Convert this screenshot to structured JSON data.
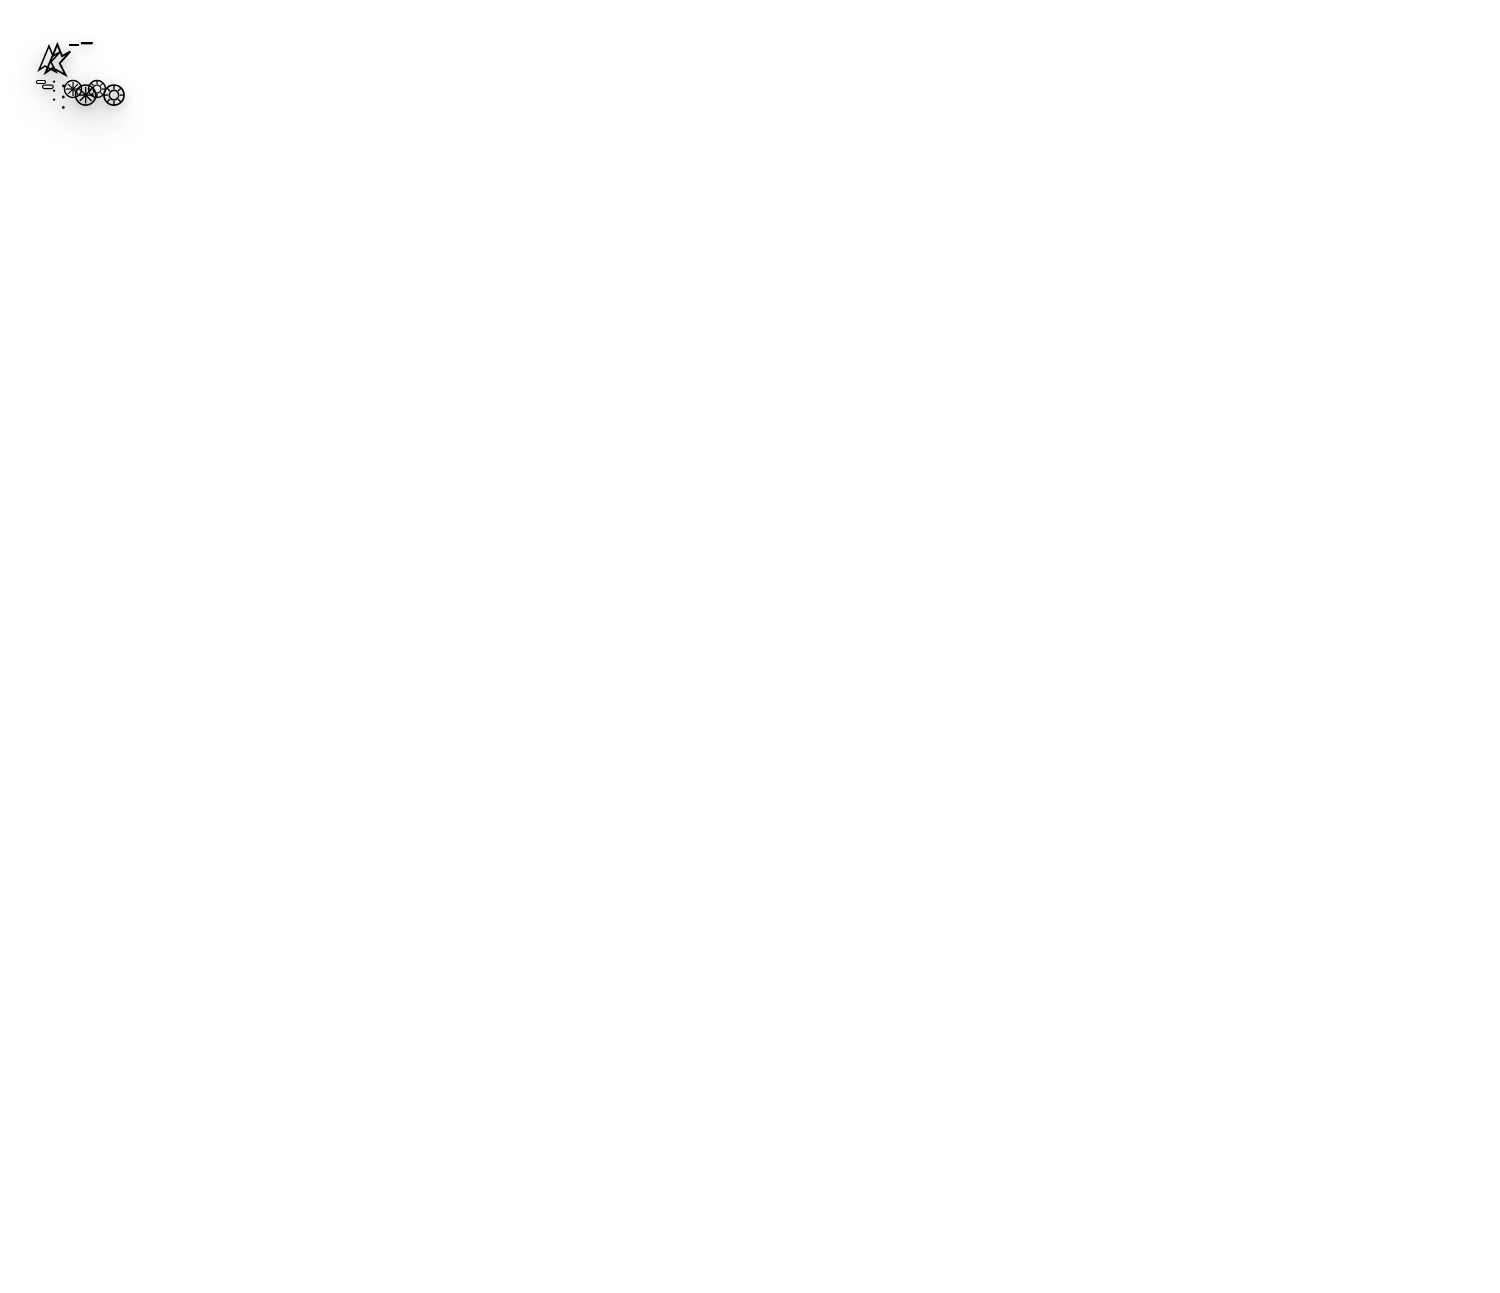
{
  "scene": {
    "width": 1500,
    "height": 1293,
    "background": "#ffffff"
  },
  "back_mat": {
    "imperial_label": "IMPERIAL",
    "branding": {
      "brand": "Elan",
      "brand_sub": "Arts & Crafts",
      "size_title": "A1 Size :",
      "size_value": "23.5 x 35.5 Inch",
      "product": "Self - Healing Cutting Mat",
      "warning": "WARNING",
      "bullets": [
        "Remain flat - Do not roll.",
        "Avoid direct heat and sunlight.",
        "Cut in different positions to extend the life of cutting mat."
      ],
      "origin": "MADE IN TAIWAN"
    },
    "colors": {
      "surface": "#0d7a68",
      "edge": "#094f42",
      "grid": "#cfc75f",
      "bright": "#e8e17a",
      "text": "#ece580"
    },
    "geometry": {
      "left": 2,
      "top": 8,
      "width": 1489,
      "height": 1114,
      "radius": 18,
      "margin": 44,
      "cols": 34.4,
      "rows": 22.4,
      "rotation": 0
    },
    "rulers": {
      "top": {
        "start": 1,
        "end": 34
      },
      "bottom": {
        "start": 1,
        "end": 34
      },
      "left": {
        "start": 1,
        "end": 22
      },
      "right": {
        "start": 1,
        "end": 22
      }
    },
    "solid_lines": [
      [
        0,
        22.4,
        22.4,
        0
      ],
      [
        0,
        22.4,
        6.0,
        0
      ],
      [
        0,
        22.4,
        12.9,
        0
      ],
      [
        24.6,
        12.6,
        34.35,
        22.35
      ]
    ],
    "dashed_lines": [
      [
        0,
        22.4,
        34.4,
        2.6
      ],
      [
        12.8,
        0,
        26.8,
        14.0
      ],
      [
        26.6,
        16.5,
        32.5,
        22.4
      ],
      [
        0,
        13.9,
        8.5,
        22.4
      ]
    ],
    "corner_arcs": [
      {
        "cx": 34.4,
        "cy": 22.4,
        "r": 2.3
      }
    ],
    "angle_arcs": [
      {
        "cx": 17.6,
        "cy": 4.8,
        "r": 1.4,
        "a0": 200,
        "a1": 340
      }
    ],
    "protractor": {
      "q": [
        [
          0,
          16.2
        ],
        [
          7.6,
          17.9
        ],
        [
          13.9,
          22.35
        ]
      ],
      "ticks": 40
    },
    "arrows": [
      [
        14.55,
        2.3,
        15.45,
        1.4
      ],
      [
        13.85,
        3.6,
        14.55,
        2.9
      ]
    ],
    "labels": [
      {
        "t": "75°",
        "x": 5.5,
        "y": 0.6,
        "s": 13
      },
      {
        "t": "60°",
        "x": 12.35,
        "y": 0.6,
        "s": 13
      },
      {
        "t": "45°",
        "x": 21.3,
        "y": 0.8,
        "s": 13
      },
      {
        "t": "90°",
        "x": 16.8,
        "y": 4.0,
        "s": 13
      },
      {
        "t": "30°",
        "x": 33.3,
        "y": 2.8,
        "s": 13
      },
      {
        "t": "45°",
        "x": 30.9,
        "y": 20.9,
        "s": 12
      },
      {
        "t": "2",
        "x": 15.05,
        "y": 1.7,
        "s": 11,
        "r": -45
      },
      {
        "t": "1",
        "x": 14.35,
        "y": 3.3,
        "s": 11,
        "r": -45
      },
      {
        "t": "80",
        "x": 0.8,
        "y": 14.45,
        "s": 11,
        "r": 12
      },
      {
        "t": "70",
        "x": 2.15,
        "y": 14.9,
        "s": 11,
        "r": 22
      },
      {
        "t": "60",
        "x": 3.55,
        "y": 15.5,
        "s": 11,
        "r": 32
      },
      {
        "t": "100",
        "x": 0.6,
        "y": 15.35,
        "s": 11,
        "r": 12
      },
      {
        "t": "110",
        "x": 1.9,
        "y": 15.85,
        "s": 11,
        "r": 22
      },
      {
        "t": "120",
        "x": 3.1,
        "y": 16.45,
        "s": 11,
        "r": 32
      },
      {
        "t": "130",
        "x": 4.3,
        "y": 17.3,
        "s": 11,
        "r": 42
      }
    ],
    "flags": [
      {
        "t": "A2",
        "x": 22.25,
        "y": 5.85,
        "fill": "#e9e06b",
        "tc": "#c0453a"
      }
    ]
  },
  "front_mat": {
    "imperial_label": "IMPERIAL",
    "origin_bottom": "MADE IN TAIWAN",
    "branding": {
      "brand": "Elan",
      "brand_sub": "Arts & Crafts",
      "size_title": "A2 Size :",
      "size_value": "18 x 23.5 Inch",
      "product": "Self - Healing Cutting Mat",
      "warning": "WARNING",
      "bullets": [
        "Remain flat - Do not roll.",
        "Avoid direct heat and sunlight.",
        "Cut in different positions to extend the life of cutting mat."
      ]
    },
    "colors": {
      "surface": "#0e7c5e",
      "edge": "#0a573f",
      "grid": "#d4e3d8",
      "bright": "#f1f7f1",
      "text": "#f2f8f2"
    },
    "geometry": {
      "left": 395,
      "top": 213,
      "width": 1108,
      "height": 815,
      "radius": 16,
      "margin": 44,
      "cols": 22.6,
      "rows": 16.5,
      "rotation": 14.3
    },
    "rulers": {
      "top": {
        "start": 1,
        "end": 22
      },
      "bottom": {
        "start": 1,
        "end": 22
      },
      "left": {
        "start": 1,
        "end": 16
      },
      "right": {
        "start": 1,
        "end": 16
      }
    },
    "solid_lines": [
      [
        7.4,
        0,
        22.6,
        15.2
      ],
      [
        0,
        16.45,
        16.45,
        0
      ],
      [
        16.6,
        0,
        22.6,
        6.0
      ],
      [
        0,
        16.45,
        4.4,
        0
      ],
      [
        0,
        16.45,
        9.5,
        0
      ],
      [
        20.5,
        14.4,
        22.55,
        16.45
      ]
    ],
    "dashed_lines": [],
    "lattice_down": [
      -18.7,
      -15.0,
      -11.2,
      -3.7,
      0.1,
      3.8
    ],
    "lattice_up": [
      4.1,
      8.25,
      12.35,
      20.6,
      24.7,
      28.8
    ],
    "corner_arcs": [
      {
        "cx": 22.6,
        "cy": 16.5,
        "r": 2.2
      }
    ],
    "angle_arcs": [
      {
        "cx": 11.9,
        "cy": 4.6,
        "r": 1.15,
        "a0": 195,
        "a1": 345
      },
      {
        "cx": 15.3,
        "cy": 8.2,
        "r": 1.15,
        "a0": 190,
        "a1": 350
      },
      {
        "cx": 19.2,
        "cy": 11.75,
        "r": 1.15,
        "a0": 185,
        "a1": 355
      },
      {
        "cx": 8.2,
        "cy": 2.0,
        "r": 1.0,
        "a0": 205,
        "a1": 330
      }
    ],
    "protractor": {
      "center": [
        0,
        16.45
      ],
      "r": 6.05,
      "a0": 270,
      "a1": 360,
      "ticks": 45
    },
    "arrows": [
      [
        8.8,
        1.95,
        9.6,
        1.15
      ]
    ],
    "labels": [
      {
        "t": "90°",
        "x": 10.85,
        "y": 3.7,
        "s": 14
      },
      {
        "t": "105°",
        "x": 14.3,
        "y": 7.45,
        "s": 14
      },
      {
        "t": "120°",
        "x": 18.4,
        "y": 11.0,
        "s": 14
      },
      {
        "t": "75°",
        "x": 7.55,
        "y": 1.4,
        "s": 13
      },
      {
        "t": "60°",
        "x": 9.0,
        "y": 0.8,
        "s": 13
      },
      {
        "t": "45°",
        "x": 16.2,
        "y": 0.55,
        "s": 12
      },
      {
        "t": "45°",
        "x": 20.15,
        "y": 15.35,
        "s": 12
      },
      {
        "t": "2",
        "x": 9.25,
        "y": 1.4,
        "s": 11,
        "r": -45
      },
      {
        "t": "60",
        "x": 0.4,
        "y": 10.6,
        "s": 10,
        "r": 20
      },
      {
        "t": "70",
        "x": 1.45,
        "y": 10.95,
        "s": 10,
        "r": 30
      },
      {
        "t": "80",
        "x": 2.45,
        "y": 11.45,
        "s": 10,
        "r": 40
      },
      {
        "t": "100",
        "x": 0.35,
        "y": 11.6,
        "s": 10,
        "r": 20
      },
      {
        "t": "110",
        "x": 1.2,
        "y": 11.95,
        "s": 10,
        "r": 30
      },
      {
        "t": "120",
        "x": 2.0,
        "y": 12.35,
        "s": 10,
        "r": 40
      },
      {
        "t": "130",
        "x": 2.7,
        "y": 12.85,
        "s": 10,
        "r": 48
      },
      {
        "t": "140",
        "x": 3.35,
        "y": 13.6,
        "s": 10,
        "r": 56
      },
      {
        "t": "150",
        "x": 3.95,
        "y": 14.4,
        "s": 10,
        "r": 63
      },
      {
        "t": "160",
        "x": 4.35,
        "y": 15.3,
        "s": 10,
        "r": 71
      },
      {
        "t": "40",
        "x": 4.2,
        "y": 12.95,
        "s": 10,
        "r": 56
      },
      {
        "t": "30",
        "x": 4.85,
        "y": 13.9,
        "s": 10,
        "r": 63
      },
      {
        "t": "20",
        "x": 5.3,
        "y": 14.9,
        "s": 10,
        "r": 71
      }
    ],
    "flags": [
      {
        "t": "A3",
        "x": 16.3,
        "y": 4.85,
        "fill": "#f1f6f2",
        "tc": "#1e7b52"
      },
      {
        "t": "A4",
        "x": 11.2,
        "y": 8.45,
        "fill": "#f1f6f2",
        "tc": "#1e7b52"
      },
      {
        "t": "A6",
        "x": 5.0,
        "y": 12.75,
        "fill": "#f4eef0",
        "tc": "#d05560"
      }
    ]
  }
}
